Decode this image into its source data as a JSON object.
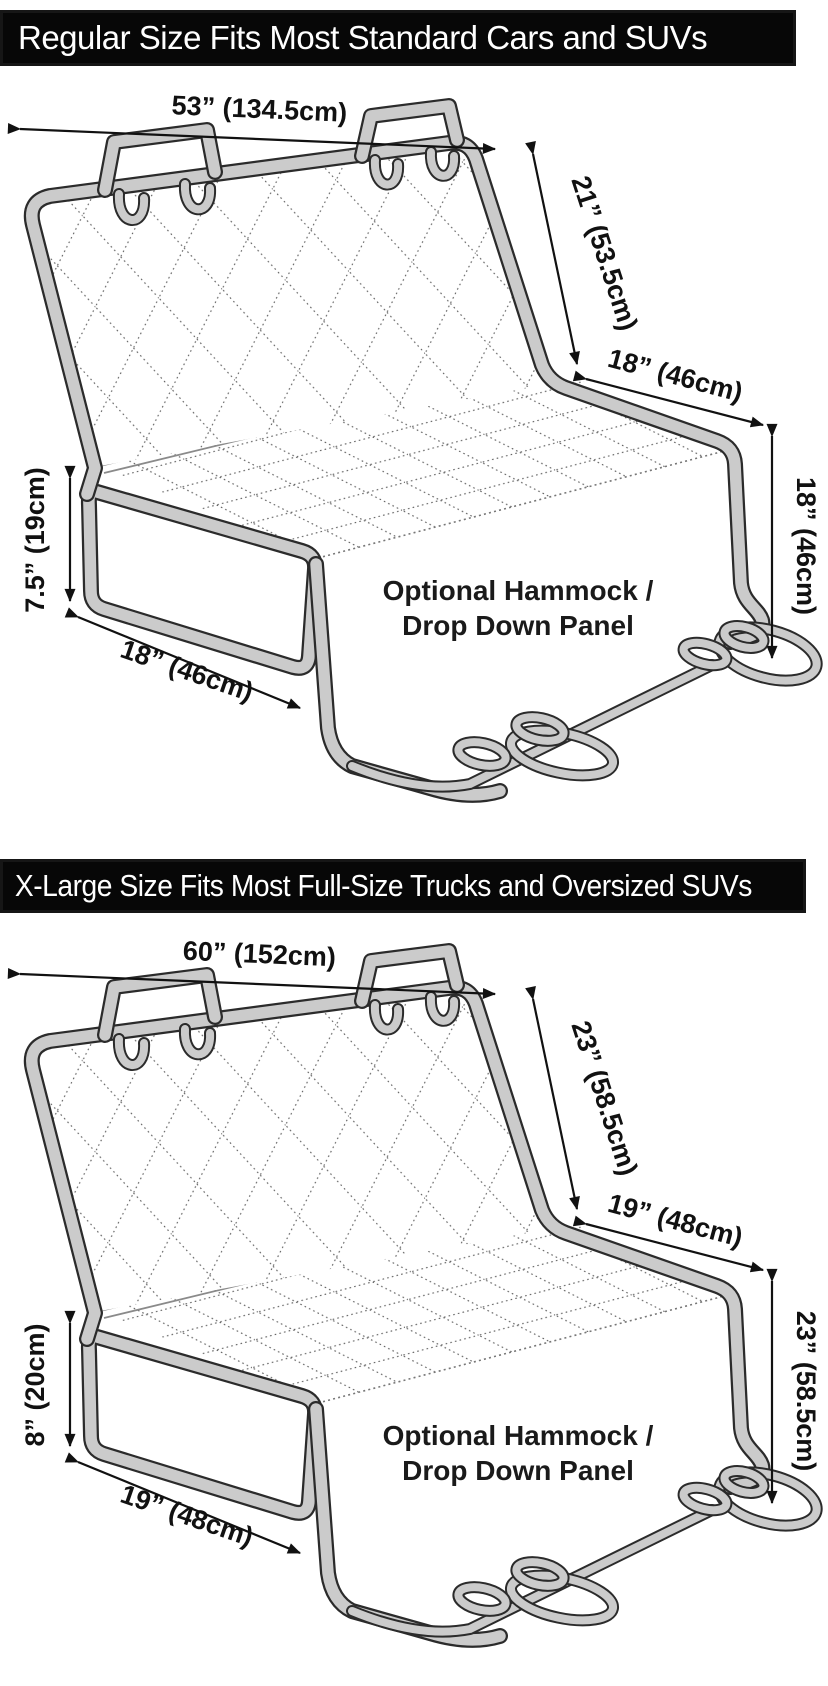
{
  "panels": [
    {
      "banner": "Regular Size Fits Most Standard Cars and SUVs",
      "dims": {
        "top": "53” (134.5cm)",
        "backrest": "21” (53.5cm)",
        "seat": "18” (46cm)",
        "right": "18” (46cm)",
        "flap_height": "7.5” (19cm)",
        "flap_width": "18” (46cm)"
      },
      "hammock": {
        "line1": "Optional Hammock /",
        "line2": "Drop Down Panel"
      }
    },
    {
      "banner": "X-Large Size Fits Most Full-Size Trucks and Oversized SUVs",
      "dims": {
        "top": "60” (152cm)",
        "backrest": "23” (58.5cm)",
        "seat": "19” (48cm)",
        "right": "23” (58.5cm)",
        "flap_height": "8” (20cm)",
        "flap_width": "19” (48cm)"
      },
      "hammock": {
        "line1": "Optional Hammock /",
        "line2": "Drop Down Panel"
      }
    }
  ],
  "colors": {
    "banner_bg": "#070707",
    "banner_text": "#ffffff",
    "tube_fill": "#cbcbcb",
    "outline": "#2b2b2b",
    "quilt_dots": "#5a5a5a",
    "dimension_text": "#111111"
  }
}
